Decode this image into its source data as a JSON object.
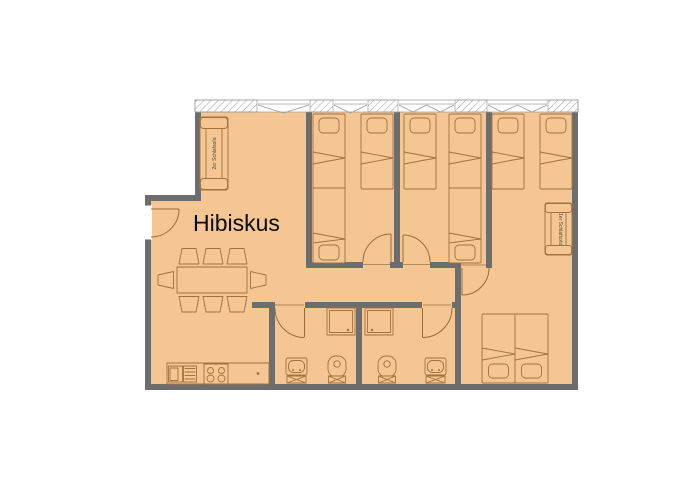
{
  "plan": {
    "title": "Hibiskus",
    "labels": {
      "sofa_double": "2er Schlafsofa",
      "armchair_single": "1er Schlafsofa"
    },
    "colors": {
      "background": "#ffffff",
      "floor": "#f4c693",
      "wall": "#6d6d6d",
      "furniture_line": "#a4723c",
      "window_line": "#9b9b9b",
      "title_text": "#0a0a0a"
    }
  }
}
